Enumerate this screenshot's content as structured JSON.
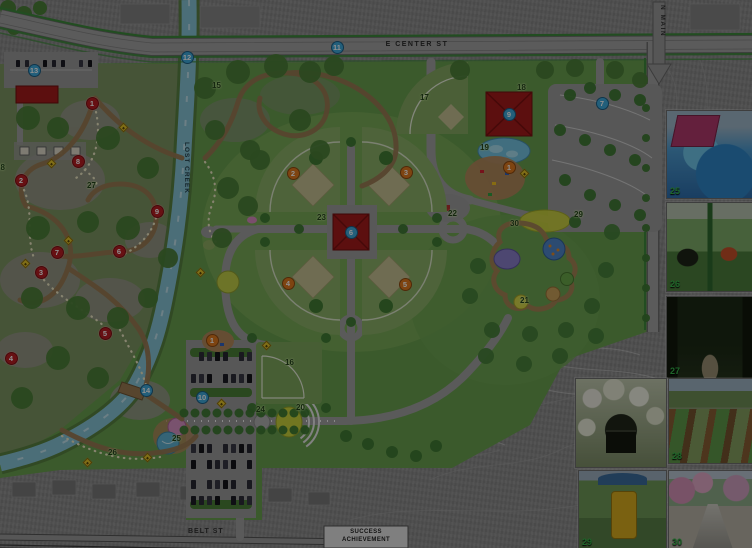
{
  "streets": {
    "e_center": "E CENTER ST",
    "belt": "BELT ST",
    "n_main": "N MAIN",
    "creek": "LOST CREEK"
  },
  "building": {
    "line1": "SUCCESS",
    "line2": "ACHIEVEMENT"
  },
  "colors": {
    "park_green": "#6aa04f",
    "creek_blue": "#86c4d6",
    "building_red": "#a51b1b",
    "red_marker": "#b81d23",
    "orange_marker": "#e07a1f",
    "blue_marker": "#3fa9dc",
    "green_label": "#22421a",
    "trail_marker_yellow": "#e6c62a"
  },
  "markers": {
    "red": [
      {
        "n": "1",
        "x": 92,
        "y": 103
      },
      {
        "n": "2",
        "x": 21,
        "y": 180
      },
      {
        "n": "3",
        "x": 41,
        "y": 272
      },
      {
        "n": "4",
        "x": 11,
        "y": 358
      },
      {
        "n": "5",
        "x": 105,
        "y": 333
      },
      {
        "n": "6",
        "x": 119,
        "y": 251
      },
      {
        "n": "7",
        "x": 57,
        "y": 252
      },
      {
        "n": "8",
        "x": 78,
        "y": 161
      },
      {
        "n": "9",
        "x": 157,
        "y": 211
      }
    ],
    "orange": [
      {
        "n": "1",
        "x": 509,
        "y": 167
      },
      {
        "n": "1",
        "x": 212,
        "y": 340
      },
      {
        "n": "2",
        "x": 293,
        "y": 173
      },
      {
        "n": "3",
        "x": 406,
        "y": 172
      },
      {
        "n": "4",
        "x": 288,
        "y": 283
      },
      {
        "n": "5",
        "x": 405,
        "y": 284
      }
    ],
    "blue": [
      {
        "n": "6",
        "x": 351,
        "y": 232
      },
      {
        "n": "7",
        "x": 602,
        "y": 103
      },
      {
        "n": "9",
        "x": 509,
        "y": 114
      },
      {
        "n": "10",
        "x": 202,
        "y": 397
      },
      {
        "n": "11",
        "x": 337,
        "y": 47
      },
      {
        "n": "12",
        "x": 187,
        "y": 57
      },
      {
        "n": "13",
        "x": 34,
        "y": 70
      },
      {
        "n": "14",
        "x": 146,
        "y": 390
      }
    ],
    "green": [
      {
        "n": "15",
        "x": 219,
        "y": 86
      },
      {
        "n": "16",
        "x": 292,
        "y": 363
      },
      {
        "n": "17",
        "x": 427,
        "y": 98
      },
      {
        "n": "18",
        "x": 524,
        "y": 88
      },
      {
        "n": "19",
        "x": 487,
        "y": 148
      },
      {
        "n": "20",
        "x": 303,
        "y": 408
      },
      {
        "n": "21",
        "x": 527,
        "y": 301
      },
      {
        "n": "22",
        "x": 455,
        "y": 214
      },
      {
        "n": "23",
        "x": 324,
        "y": 218
      },
      {
        "n": "24",
        "x": 263,
        "y": 410
      },
      {
        "n": "25",
        "x": 179,
        "y": 439
      },
      {
        "n": "26",
        "x": 115,
        "y": 453
      },
      {
        "n": "27",
        "x": 94,
        "y": 186
      },
      {
        "n": "28",
        "x": 3,
        "y": 168
      },
      {
        "n": "29",
        "x": 581,
        "y": 215
      },
      {
        "n": "30",
        "x": 517,
        "y": 224
      }
    ],
    "trail_diamonds": [
      [
        123,
        127
      ],
      [
        51,
        163
      ],
      [
        25,
        263
      ],
      [
        68,
        240
      ],
      [
        200,
        272
      ],
      [
        266,
        345
      ],
      [
        221,
        403
      ],
      [
        147,
        457
      ],
      [
        87,
        462
      ],
      [
        524,
        173
      ]
    ]
  },
  "photos": [
    {
      "label": "25",
      "kind": "splash-pad",
      "x": 666,
      "y": 110,
      "w": 86,
      "h": 87
    },
    {
      "label": "26",
      "kind": "accessible-swings",
      "x": 666,
      "y": 202,
      "w": 86,
      "h": 88
    },
    {
      "label": "27",
      "kind": "forest-trail",
      "x": 666,
      "y": 296,
      "w": 86,
      "h": 81
    },
    {
      "label": "",
      "kind": "rose-arbor-bench",
      "x": 575,
      "y": 378,
      "w": 90,
      "h": 88
    },
    {
      "label": "28",
      "kind": "garden-beds",
      "x": 668,
      "y": 378,
      "w": 84,
      "h": 84
    },
    {
      "label": "29",
      "kind": "adaptive-swing",
      "x": 578,
      "y": 470,
      "w": 87,
      "h": 78
    },
    {
      "label": "30",
      "kind": "blossom-promenade",
      "x": 668,
      "y": 470,
      "w": 84,
      "h": 78
    }
  ]
}
